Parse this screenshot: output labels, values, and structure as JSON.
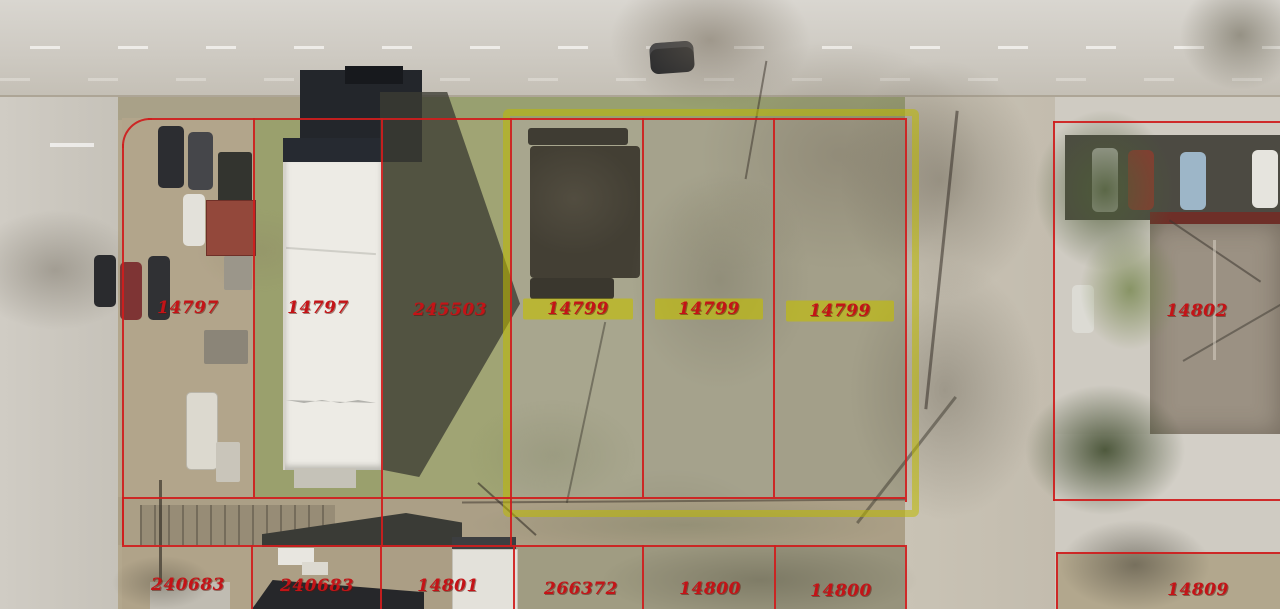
{
  "view": {
    "type": "aerial-parcel-map",
    "colors": {
      "parcel_line": "#cf1d1d",
      "selected_outline": "#b9b400",
      "label_text": "#c41317",
      "road": "#ccc8c0",
      "grass": "#9aa06d",
      "dirt": "#b3a78d"
    }
  },
  "labels": [
    {
      "id": "parcel-14797-a",
      "text": "14797",
      "highlighted": false
    },
    {
      "id": "parcel-14797-b",
      "text": "14797",
      "highlighted": false
    },
    {
      "id": "parcel-245503",
      "text": "245503",
      "highlighted": false
    },
    {
      "id": "parcel-14799-a",
      "text": "14799",
      "highlighted": true
    },
    {
      "id": "parcel-14799-b",
      "text": "14799",
      "highlighted": true
    },
    {
      "id": "parcel-14799-c",
      "text": "14799",
      "highlighted": true
    },
    {
      "id": "parcel-14802",
      "text": "14802",
      "highlighted": false
    },
    {
      "id": "parcel-240683-a",
      "text": "240683",
      "highlighted": false
    },
    {
      "id": "parcel-240683-b",
      "text": "240683",
      "highlighted": false
    },
    {
      "id": "parcel-14801",
      "text": "14801",
      "highlighted": false
    },
    {
      "id": "parcel-266372",
      "text": "266372",
      "highlighted": false
    },
    {
      "id": "parcel-14800-a",
      "text": "14800",
      "highlighted": false
    },
    {
      "id": "parcel-14800-b",
      "text": "14800",
      "highlighted": false
    },
    {
      "id": "parcel-14809",
      "text": "14809",
      "highlighted": false
    }
  ]
}
